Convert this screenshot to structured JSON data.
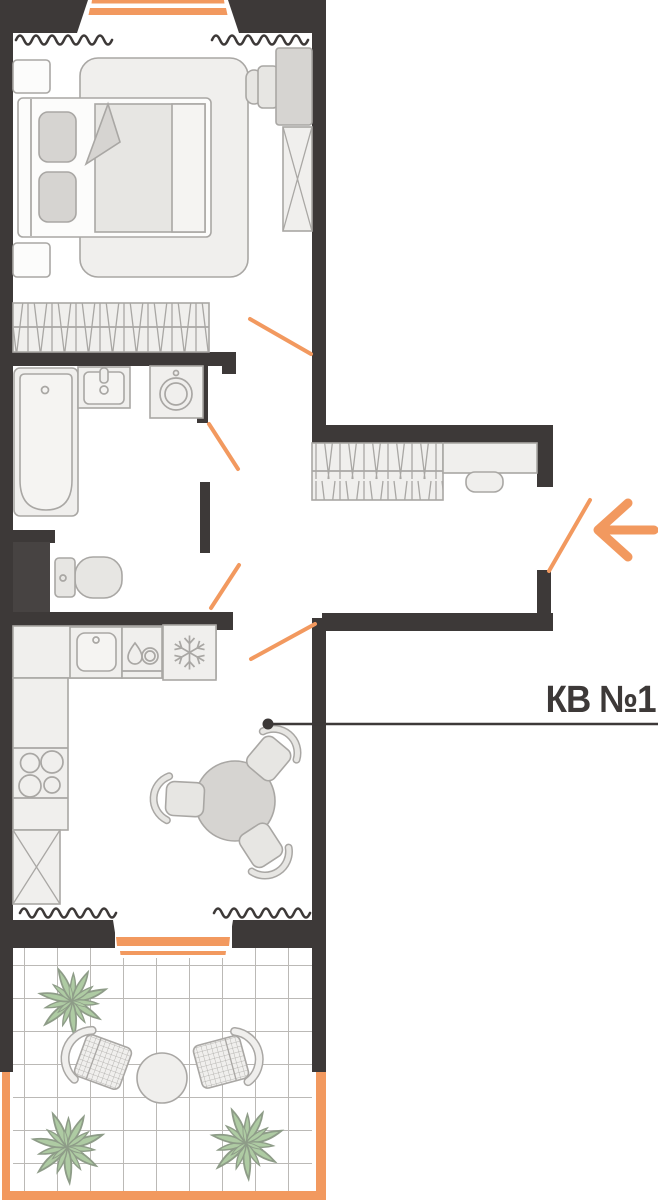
{
  "annotation": {
    "label": "КВ №1",
    "arrow_direction": "left",
    "leader_dot": true
  },
  "colors": {
    "wall": "#3D3938",
    "shaft": "#474342",
    "accent_orange": "#F2995F",
    "furniture_line": "#A9A7A4",
    "furniture_fill": "#F0EFED",
    "furniture_fill_mid": "#E7E6E3",
    "furniture_fill_dark": "#D6D4D1",
    "plant_green": "#AECBA3",
    "plant_line": "#8E9C88",
    "tile_line": "#BBB9B6",
    "background": "#FFFFFF"
  },
  "rooms": [
    {
      "name": "bedroom",
      "items": [
        "double-bed-icon",
        "pillow-icon",
        "blanket-fold-icon",
        "rug-icon",
        "nightstand-icon",
        "desk-icon",
        "desk-chair-icon",
        "wardrobe-x-icon",
        "closet-hanging-rod-icon",
        "window-icon",
        "balcony-door-top-icon",
        "door-swing-icon"
      ]
    },
    {
      "name": "bathroom",
      "items": [
        "bathtub-icon",
        "washbasin-icon",
        "washing-machine-icon",
        "door-swing-icon"
      ]
    },
    {
      "name": "wc",
      "items": [
        "toilet-icon",
        "duct-shaft",
        "door-swing-icon"
      ]
    },
    {
      "name": "hallway",
      "items": [
        "coat-rack-icon",
        "bench-icon",
        "pouf-icon",
        "entrance-door-swing-icon",
        "entrance-arrow-icon"
      ]
    },
    {
      "name": "kitchen-living",
      "items": [
        "kitchen-counter-icon",
        "kitchen-sink-icon",
        "dishwasher-icon",
        "fridge-snowflake-icon",
        "stove-burners-icon",
        "base-cabinet-x-icon",
        "dining-table-icon",
        "dining-chair-icon",
        "window-icon",
        "balcony-door-bottom-icon",
        "door-swing-icon"
      ]
    },
    {
      "name": "balcony",
      "items": [
        "tile-floor",
        "plant-icon",
        "wicker-chair-icon",
        "coffee-table-icon",
        "railing"
      ]
    }
  ]
}
